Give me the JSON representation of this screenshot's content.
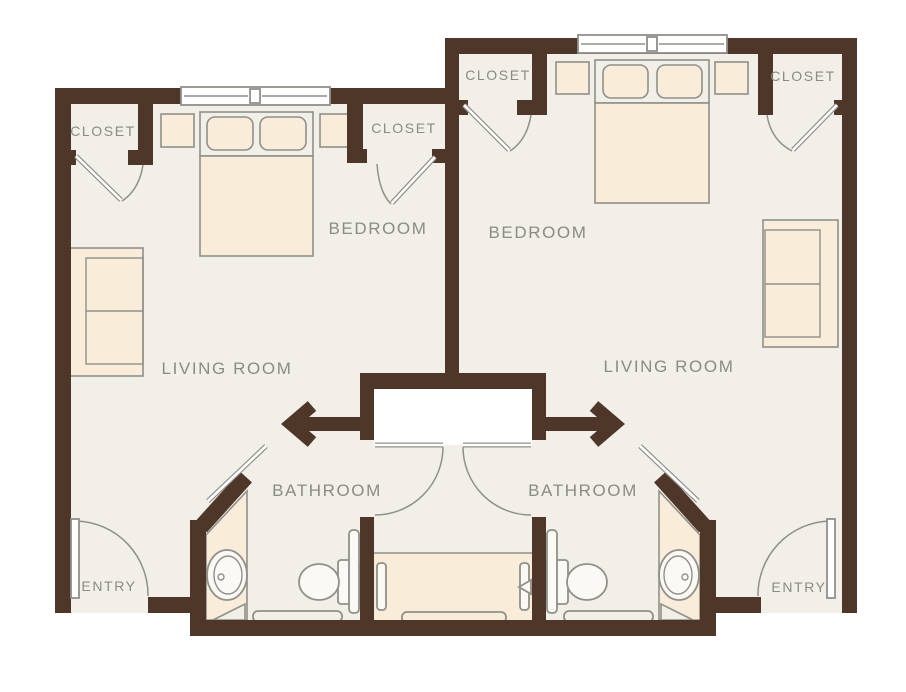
{
  "colors": {
    "wall": "#4e3729",
    "floor": "#f1efe8",
    "furniture": "#f9ecd9",
    "fixture": "#fbf9f3",
    "outline": "#90908a",
    "label": "#8b8b84",
    "white": "#ffffff"
  },
  "units": {
    "left": {
      "closet_left": "CLOSET",
      "closet_right": "CLOSET",
      "bedroom": "BEDROOM",
      "living_room": "LIVING ROOM",
      "bathroom": "BATHROOM",
      "entry": "ENTRY"
    },
    "right": {
      "closet_left": "CLOSET",
      "closet_right": "CLOSET",
      "bedroom": "BEDROOM",
      "living_room": "LIVING ROOM",
      "bathroom": "BATHROOM",
      "entry": "ENTRY"
    }
  }
}
